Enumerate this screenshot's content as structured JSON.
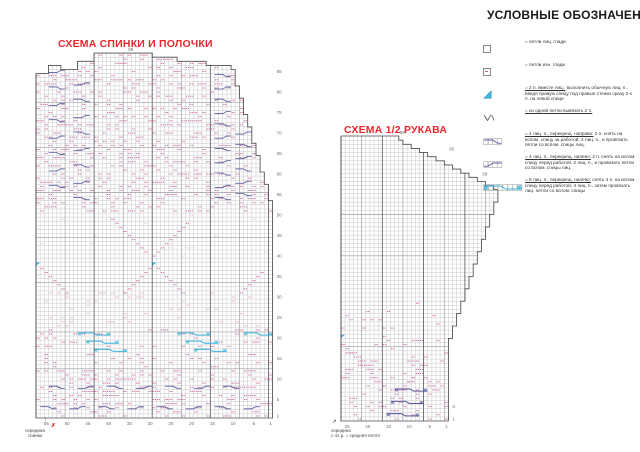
{
  "colors": {
    "title_red": "#e8282d",
    "pink": "#c9699e",
    "pink_light": "#ecc0d6",
    "navy": "#5b5b9e",
    "cyan": "#3db5dc",
    "grid": "#c8c8cd",
    "grid_med": "#9a9aa0",
    "grid_dark": "#55555c",
    "outline": "#4d4d52",
    "number": "#6b6b6b"
  },
  "legend": {
    "title": "УСЛОВНЫЕ ОБОЗНАЧЕНИЯ",
    "items": [
      {
        "icon": "knit-stitch",
        "lead": "",
        "rest": "= петли лиц. глади"
      },
      {
        "icon": "purl-stitch",
        "lead": "",
        "rest": "= петли изн. глади"
      },
      {
        "icon": "k2tog-triangle",
        "lead": "= 2 п. вместе лиц.:",
        "rest": " выполнить обычную лиц. п., введя правую спицу под правые стенки сразу 2-х п. на левой спице"
      },
      {
        "icon": "inc-from-one",
        "lead": "= из одной петли вывязать 2 п.",
        "rest": ""
      },
      {
        "icon": "cable4-right",
        "lead": "= 4 лиц. п., перекрещ. направо:",
        "rest": " 2 п. снять на вспом. спицу за работой, 2 лиц. п., и провязать петли со вспом. спицы лиц."
      },
      {
        "icon": "cable4-left",
        "lead": "= 4 лиц. п., перекрещ. налево:",
        "rest": " 2 п. снять на вспом. спицу перед работой, 2 лиц. п., и провязать петли со вспом. спицы лиц."
      },
      {
        "icon": "cable8-left",
        "lead": "= 8 лиц. п., перекрещ. налево:",
        "rest": " снять 4 п. на вспом. спицу перед работой, 4 лиц. п., затем провязать лиц. петли со вспом. спицы"
      }
    ]
  },
  "charts": [
    {
      "id": "back-front-chart",
      "title": "СХЕМА СПИНКИ И ПОЛОЧКИ",
      "bottom_label_lines": [
        "середина",
        "спинки"
      ],
      "arrow": "↑",
      "marker": "✗",
      "geometry": {
        "x0": 36,
        "y_bottom": 418,
        "cell_w": 4.15,
        "cell_h": 4.1,
        "cols": 57,
        "rows": 89,
        "top_segments": [
          [
            0,
            2,
            84
          ],
          [
            3,
            5,
            86
          ],
          [
            6,
            9,
            85
          ],
          [
            10,
            13,
            87
          ],
          [
            14,
            27,
            89
          ],
          [
            28,
            33,
            88
          ],
          [
            34,
            40,
            87
          ],
          [
            41,
            46,
            86
          ]
        ],
        "top_slope": {
          "from": 47,
          "to": 56,
          "start": 85,
          "end": 53
        },
        "v_med": 7,
        "v_dark": 14,
        "h_dark_rows": [
          12,
          21,
          33,
          44,
          55,
          66,
          77
        ],
        "bottom_numbers": [
          55,
          50,
          45,
          40,
          35,
          30,
          25,
          20,
          15,
          10,
          5,
          1
        ],
        "side_numbers": [
          1,
          5,
          10,
          15,
          20,
          25,
          30,
          35,
          40,
          45,
          50,
          55,
          60,
          65,
          70,
          75,
          80,
          85
        ],
        "top_label": {
          "text": "89",
          "col": 22
        },
        "seed": 11
      },
      "pattern": [
        {
          "type": "scatter",
          "cols": [
            0,
            56
          ],
          "rows": [
            0,
            11
          ],
          "density": 0.24,
          "color": "pink"
        },
        {
          "type": "scatter",
          "cols": [
            0,
            56
          ],
          "rows": [
            12,
            21
          ],
          "density": 0.13,
          "color": "pink"
        },
        {
          "type": "scatter",
          "cols": [
            2,
            54
          ],
          "rows": [
            22,
            30
          ],
          "density": 0.1,
          "color": "pink_light",
          "big": true
        },
        {
          "type": "scatter",
          "cols": [
            0,
            56
          ],
          "rows": [
            38,
            49
          ],
          "density": 0.04,
          "color": "pink_light"
        },
        {
          "type": "scatter",
          "cols": [
            0,
            56
          ],
          "rows": [
            50,
            88
          ],
          "density": 0.26,
          "color": "pink"
        },
        {
          "type": "cableRow",
          "row": 2,
          "from": 1,
          "to": 54,
          "spacing": 7
        },
        {
          "type": "cableRow",
          "row": 7,
          "from": 3,
          "to": 54,
          "spacing": 7
        },
        {
          "type": "cable8",
          "color": "cyan",
          "items": [
            [
              10,
              20
            ],
            [
              12,
              18
            ],
            [
              14,
              16
            ],
            [
              34,
              20
            ],
            [
              36,
              18
            ],
            [
              38,
              16
            ],
            [
              50,
              20
            ]
          ]
        },
        {
          "type": "tri",
          "color": "cyan",
          "items": [
            [
              0,
              37
            ],
            [
              28,
              37
            ]
          ]
        },
        {
          "type": "diag",
          "from": [
            1,
            36
          ],
          "n": 7,
          "dc": 1,
          "dr": -1
        },
        {
          "type": "diag",
          "from": [
            29,
            36
          ],
          "n": 7,
          "dc": 1,
          "dr": -1
        },
        {
          "type": "diag",
          "from": [
            21,
            30
          ],
          "n": 7,
          "dc": 1,
          "dr": 1
        },
        {
          "type": "diag",
          "from": [
            49,
            30
          ],
          "n": 6,
          "dc": 1,
          "dr": 1
        },
        {
          "type": "diag",
          "from": [
            18,
            48
          ],
          "n": 9,
          "dc": 1,
          "dr": -1
        },
        {
          "type": "diag",
          "from": [
            28,
            39
          ],
          "n": 9,
          "dc": 1,
          "dr": 1
        },
        {
          "type": "cablePanel",
          "col": 3,
          "rows": [
            56,
            84
          ],
          "every": 4
        },
        {
          "type": "cablePanel",
          "col": 9,
          "rows": [
            53,
            87
          ],
          "every": 4
        },
        {
          "type": "cablePanel",
          "col": 43,
          "rows": [
            53,
            87
          ],
          "every": 3
        },
        {
          "type": "cablePanel",
          "col": 48,
          "rows": [
            54,
            88
          ],
          "every": 3
        }
      ]
    },
    {
      "id": "sleeve-chart",
      "title": "СХЕМА 1/2 РУКАВА",
      "bottom_label_lines": [
        "середина",
        "с 41 р. = средняя петля"
      ],
      "arrow": "↗",
      "marker": "",
      "geometry": {
        "x0": 341,
        "y_bottom": 421,
        "cell_w": 4.13,
        "cell_h": 4.13,
        "cols": 38,
        "rows": 69,
        "cols_bottom": 26,
        "top_segments": [
          [
            0,
            13,
            69
          ]
        ],
        "top_slope": {
          "from": 14,
          "to": 37,
          "start": 68,
          "end": 56
        },
        "bottom_slope": {
          "from": 26,
          "start": 20,
          "step": 3
        },
        "v_med": 5,
        "v_dark": 10,
        "h_dark_rows": [
          18,
          40,
          50
        ],
        "bottom_numbers": [
          25,
          20,
          15,
          10,
          5,
          1
        ],
        "side_numbers": [
          {
            "t": "3",
            "r": 4
          },
          {
            "t": "1",
            "r": 1
          }
        ],
        "step_labels": [
          {
            "t": "69",
            "c": 14
          },
          {
            "t": "65",
            "c": 26
          },
          {
            "t": "59",
            "c": 34
          }
        ],
        "seed": 5
      },
      "pattern": [
        {
          "type": "scatter",
          "cols": [
            0,
            25
          ],
          "rows": [
            0,
            19
          ],
          "density": 0.16,
          "color": "pink"
        },
        {
          "type": "scatter",
          "cols": [
            0,
            27
          ],
          "rows": [
            20,
            28
          ],
          "density": 0.05,
          "color": "pink"
        },
        {
          "type": "diag",
          "from": [
            0,
            18
          ],
          "n": 11,
          "dc": 1,
          "dr": -1
        },
        {
          "type": "diag",
          "from": [
            13,
            6
          ],
          "n": 8,
          "dc": 1,
          "dr": 1
        },
        {
          "type": "diag",
          "from": [
            16,
            14
          ],
          "n": 8,
          "dc": 1,
          "dr": -1
        },
        {
          "type": "cable8",
          "color": "navy",
          "items": [
            [
              11,
              1
            ],
            [
              12,
              4
            ],
            [
              13,
              7
            ]
          ]
        },
        {
          "type": "tri",
          "color": "cyan",
          "items": [
            [
              0,
              20
            ]
          ]
        }
      ]
    }
  ]
}
